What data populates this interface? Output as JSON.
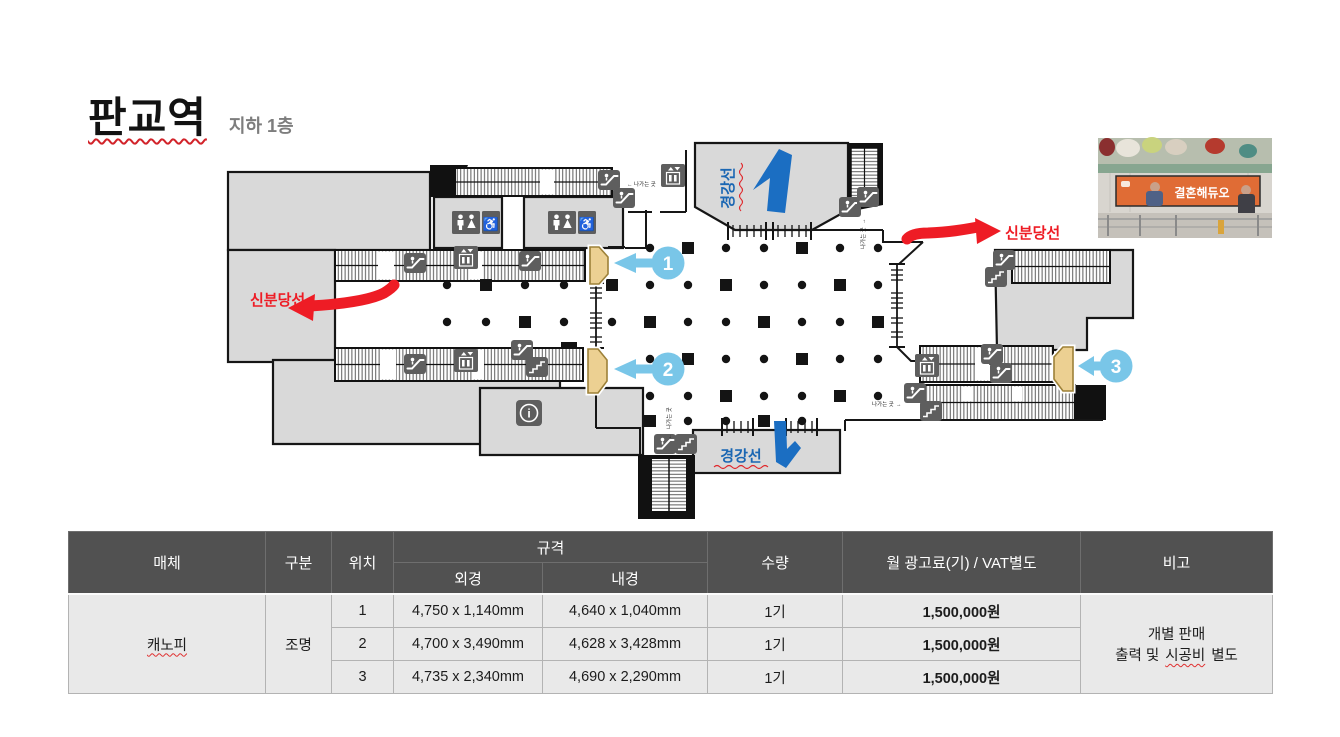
{
  "header": {
    "title": "판교역",
    "subtitle": "지하 1층"
  },
  "map": {
    "line_shinbundang": "신분당선",
    "line_gyeonggang": "경강선",
    "exit_label": "나가는 곳",
    "markers": [
      "1",
      "2",
      "3"
    ],
    "colors": {
      "red_line": "#ee1c25",
      "blue_line": "#1b67b3",
      "badge_blue": "#79c6e8",
      "canopy_marker": "#ecd092"
    }
  },
  "photo": {
    "banner_text": "결혼해듀오"
  },
  "table": {
    "headers": {
      "media": "매체",
      "category": "구분",
      "location": "위치",
      "spec": "규격",
      "spec_outer": "외경",
      "spec_inner": "내경",
      "qty": "수량",
      "price": "월 광고료(기) / VAT별도",
      "note": "비고"
    },
    "media": "캐노피",
    "category": "조명",
    "rows": [
      {
        "loc": "1",
        "outer": "4,750 x 1,140mm",
        "inner": "4,640 x 1,040mm",
        "qty": "1기",
        "price": "1,500,000원"
      },
      {
        "loc": "2",
        "outer": "4,700 x 3,490mm",
        "inner": "4,628 x 3,428mm",
        "qty": "1기",
        "price": "1,500,000원"
      },
      {
        "loc": "3",
        "outer": "4,735 x 2,340mm",
        "inner": "4,690 x 2,290mm",
        "qty": "1기",
        "price": "1,500,000원"
      }
    ],
    "note_line1": "개별 판매",
    "note_line2_parts": [
      "출력 및",
      "시공비",
      "별도"
    ]
  }
}
